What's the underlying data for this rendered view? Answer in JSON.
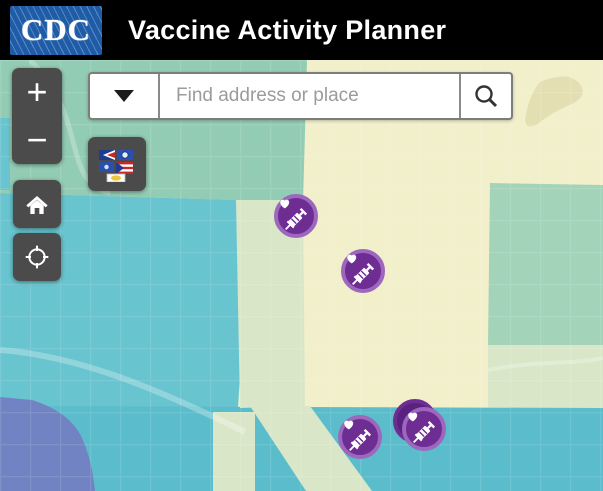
{
  "header": {
    "logo_text": "CDC",
    "title": "Vaccine Activity Planner"
  },
  "search": {
    "placeholder": "Find address or place",
    "value": ""
  },
  "controls": {
    "zoom_in_label": "+",
    "zoom_out_label": "−"
  },
  "icons": {
    "dropdown": "chevron-down-icon",
    "search": "magnifier-icon",
    "home": "home-icon",
    "locate": "crosshair-icon",
    "territories": "territory-flags-icon",
    "marker": "heart-syringe-icon"
  },
  "colors": {
    "header_bg": "#000000",
    "logo_blue": "#1e5ca8",
    "widget_gray": "#4b4b4b",
    "marker_fill": "#6e2d92",
    "marker_ring": "#9c67bd",
    "marker_back_fill": "#5a2280",
    "map_yellow": "#f2efcb",
    "map_green_topleft": "#93ccb4",
    "map_teal": "#68c4cf",
    "map_teal_deep": "#5bbdcb",
    "map_pale_green": "#d9e7c8",
    "map_right_green": "#a3d3b9",
    "map_blue_zone": "#7183c2",
    "map_park_beige": "#e4dfb2",
    "street_line": "rgba(255,255,255,0.20)"
  },
  "map": {
    "marker_count": 5,
    "markers": [
      {
        "x": 296,
        "y": 156,
        "stacked": false
      },
      {
        "x": 363,
        "y": 211,
        "stacked": false
      },
      {
        "x": 360,
        "y": 377,
        "stacked": false
      },
      {
        "x": 424,
        "y": 369,
        "stacked": true
      }
    ]
  }
}
